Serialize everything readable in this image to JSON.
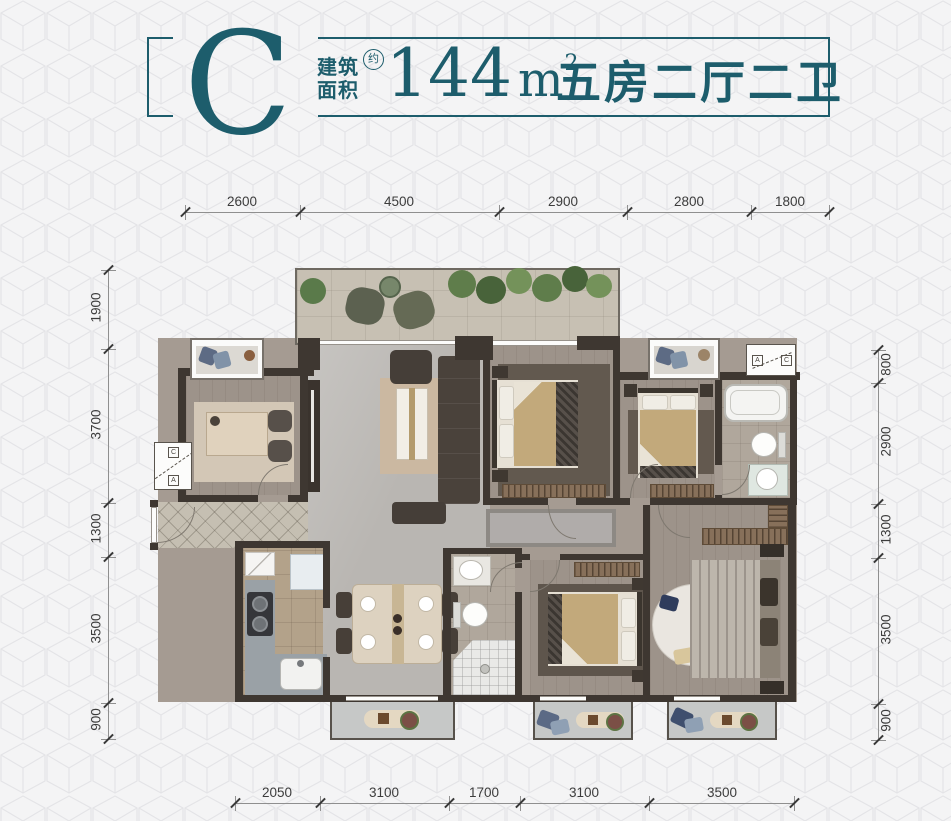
{
  "header": {
    "unit": "C",
    "area_label_line1": "建筑",
    "area_label_line2": "面积",
    "approx": "约",
    "area_value": "144",
    "area_unit_base": "m",
    "area_unit_exponent": "2",
    "rooms_summary": "五房二厅二卫",
    "accent_color": "#1d5d6c"
  },
  "dimensions_mm": {
    "top": [
      "2600",
      "4500",
      "2900",
      "2800",
      "1800"
    ],
    "bottom": [
      "2050",
      "3100",
      "1700",
      "3100",
      "3500"
    ],
    "left": [
      "1900",
      "3700",
      "1300",
      "3500",
      "900"
    ],
    "right": [
      "800",
      "2900",
      "1300",
      "3500",
      "900"
    ]
  },
  "ac_platform": {
    "letter_a": "A",
    "letter_c": "C"
  }
}
